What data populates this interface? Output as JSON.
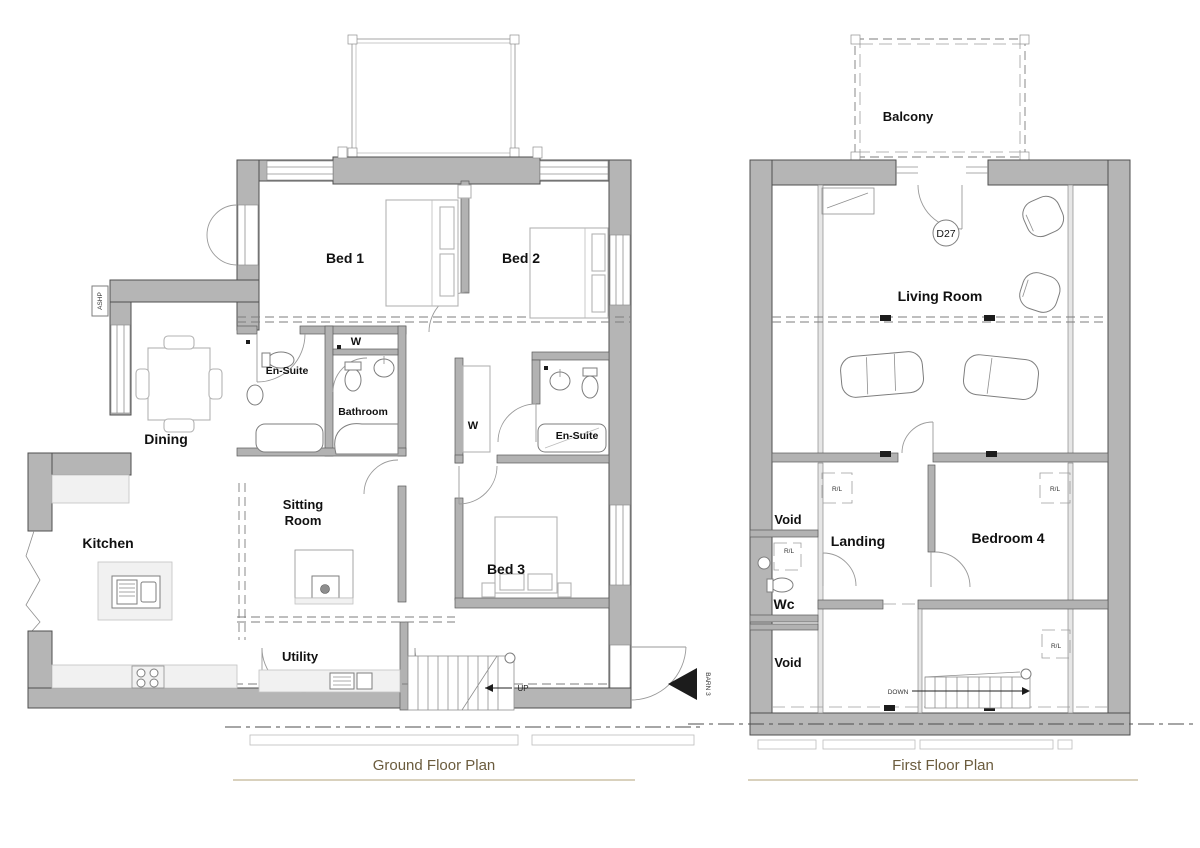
{
  "colors": {
    "wall_fill": "#b5b5b5",
    "wall_stroke": "#4f4f4f",
    "title_text": "#6b5c3e",
    "title_rule": "#d9d1bd",
    "marker_black": "#1c1c1c"
  },
  "ground_floor": {
    "title": "Ground Floor Plan",
    "rooms": {
      "bed1": "Bed 1",
      "bed2": "Bed 2",
      "ensuite1": "En-Suite",
      "wardrobe1": "W",
      "bathroom": "Bathroom",
      "wardrobe2": "W",
      "ensuite2": "En-Suite",
      "dining": "Dining",
      "kitchen": "Kitchen",
      "sitting1": "Sitting",
      "sitting2": "Room",
      "bed3": "Bed 3",
      "utility": "Utility"
    },
    "annotations": {
      "ashp": "ASHP",
      "up": "UP",
      "barn": "BARN 3"
    }
  },
  "first_floor": {
    "title": "First Floor Plan",
    "rooms": {
      "balcony": "Balcony",
      "living_room": "Living Room",
      "void1": "Void",
      "landing": "Landing",
      "bedroom4": "Bedroom 4",
      "wc": "Wc",
      "void2": "Void"
    },
    "annotations": {
      "d27": "D27",
      "down": "DOWN",
      "rl": "R/L"
    }
  }
}
